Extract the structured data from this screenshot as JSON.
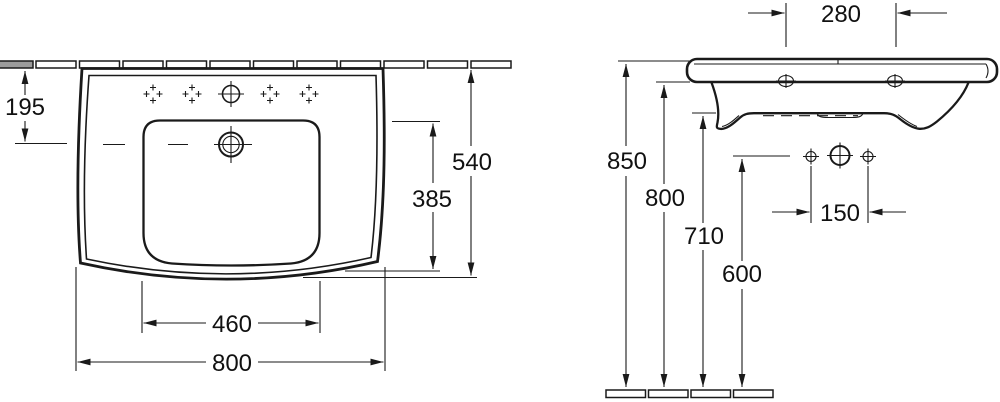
{
  "drawing": {
    "type": "washbasin dimension drawing",
    "colors": {
      "line": "#1a1a1a",
      "background": "#ffffff",
      "shaded_tile": "#9b9b9b"
    },
    "front_view": {
      "name": "front view",
      "dims": {
        "rim_to_taphole": "195",
        "total_height": "540",
        "bowl_depth": "385",
        "bowl_width": "460",
        "total_width": "800"
      }
    },
    "side_view": {
      "name": "side view",
      "dims": {
        "fixing_holes_spacing": "280",
        "rim_height": "850",
        "underside_height": "800",
        "apron_bottom_height": "710",
        "bolt_holes_height": "600",
        "bolt_holes_spacing": "150"
      }
    }
  }
}
